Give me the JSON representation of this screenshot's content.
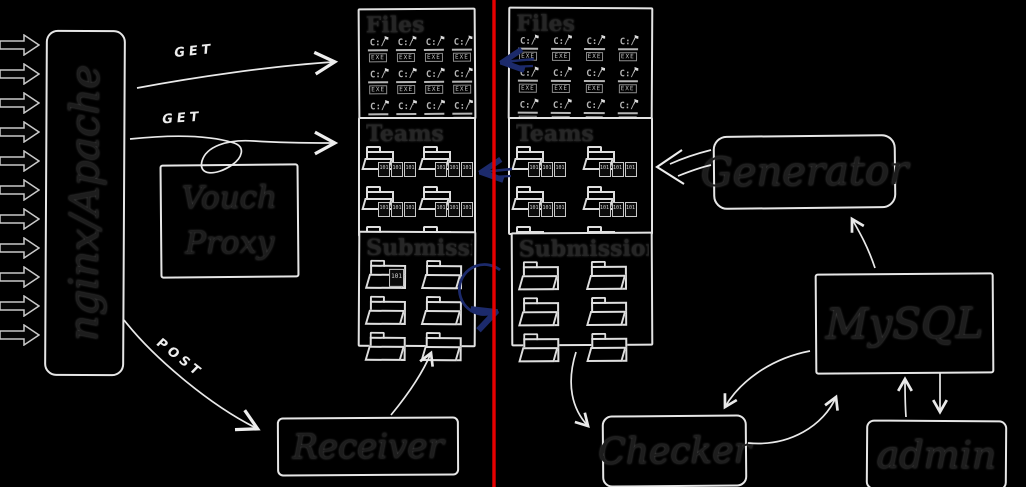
{
  "colors": {
    "background": "#000000",
    "stroke_light": "#e9e9e9",
    "label_dark": "#1d1d1d",
    "handwriting": "#ededed",
    "blue_arrow": "#1c2a6b",
    "divider_red": "#e60000"
  },
  "incoming": {
    "count": 11
  },
  "nodes": {
    "nginx": {
      "label": "nginx/Apache"
    },
    "vouch": {
      "label": "Vouch Proxy"
    },
    "generator": {
      "label": "Generator"
    },
    "mysql": {
      "label": "MySQL"
    },
    "admin": {
      "label": "admin"
    },
    "receiver": {
      "label": "Receiver"
    },
    "checker": {
      "label": "Checker"
    }
  },
  "stores": {
    "files_left": {
      "title": "Files",
      "icon": "dos-exe-icon",
      "count": 12
    },
    "teams_left": {
      "title": "Teams",
      "icon": "team-folder-icon",
      "count": 6
    },
    "submissions_left": {
      "title": "Submissions",
      "icon": "folder-icon",
      "count": 6
    },
    "files_right": {
      "title": "Files",
      "icon": "dos-exe-icon",
      "count": 12
    },
    "teams_right": {
      "title": "Teams",
      "icon": "team-folder-icon",
      "count": 6
    },
    "submissions_right": {
      "title": "Submissions",
      "icon": "folder-icon",
      "count": 6
    }
  },
  "edges": {
    "get_files": {
      "label": "GET"
    },
    "get_teams": {
      "label": "GET"
    },
    "post": {
      "label": "POST"
    }
  },
  "icons": {
    "exe_drive": "C:/",
    "exe_label": "EXE",
    "binary_glyph": "101",
    "flag_glyph": "⚑"
  }
}
